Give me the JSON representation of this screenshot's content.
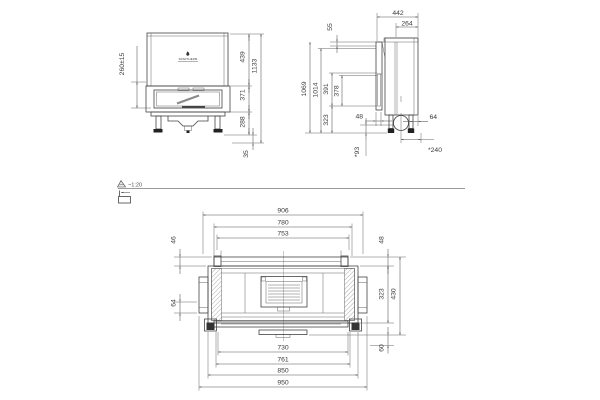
{
  "drawing": {
    "scale_note": "~1:20",
    "brand": "SPARTHERM",
    "front": {
      "lift": "260±15",
      "upper": "439",
      "door": "371",
      "base": "288",
      "total": "1133",
      "feet": "35"
    },
    "side": {
      "depth": "442",
      "top_depth": "264",
      "top": "55",
      "h_total": "1069",
      "h_inner": "1014",
      "glass_a": "391",
      "glass_b": "378",
      "base": "323",
      "front_offset": "48",
      "rear_offset": "64",
      "duct_height": "*93",
      "duct_depth": "*240"
    },
    "plan": {
      "w_a": "906",
      "w_b": "780",
      "w_c": "753",
      "back_l": "46",
      "back_r": "48",
      "side_l": "64",
      "depth_a": "323",
      "depth_b": "430",
      "front_r": "60",
      "w_d": "730",
      "w_e": "761",
      "w_f": "850",
      "w_g": "950"
    }
  }
}
